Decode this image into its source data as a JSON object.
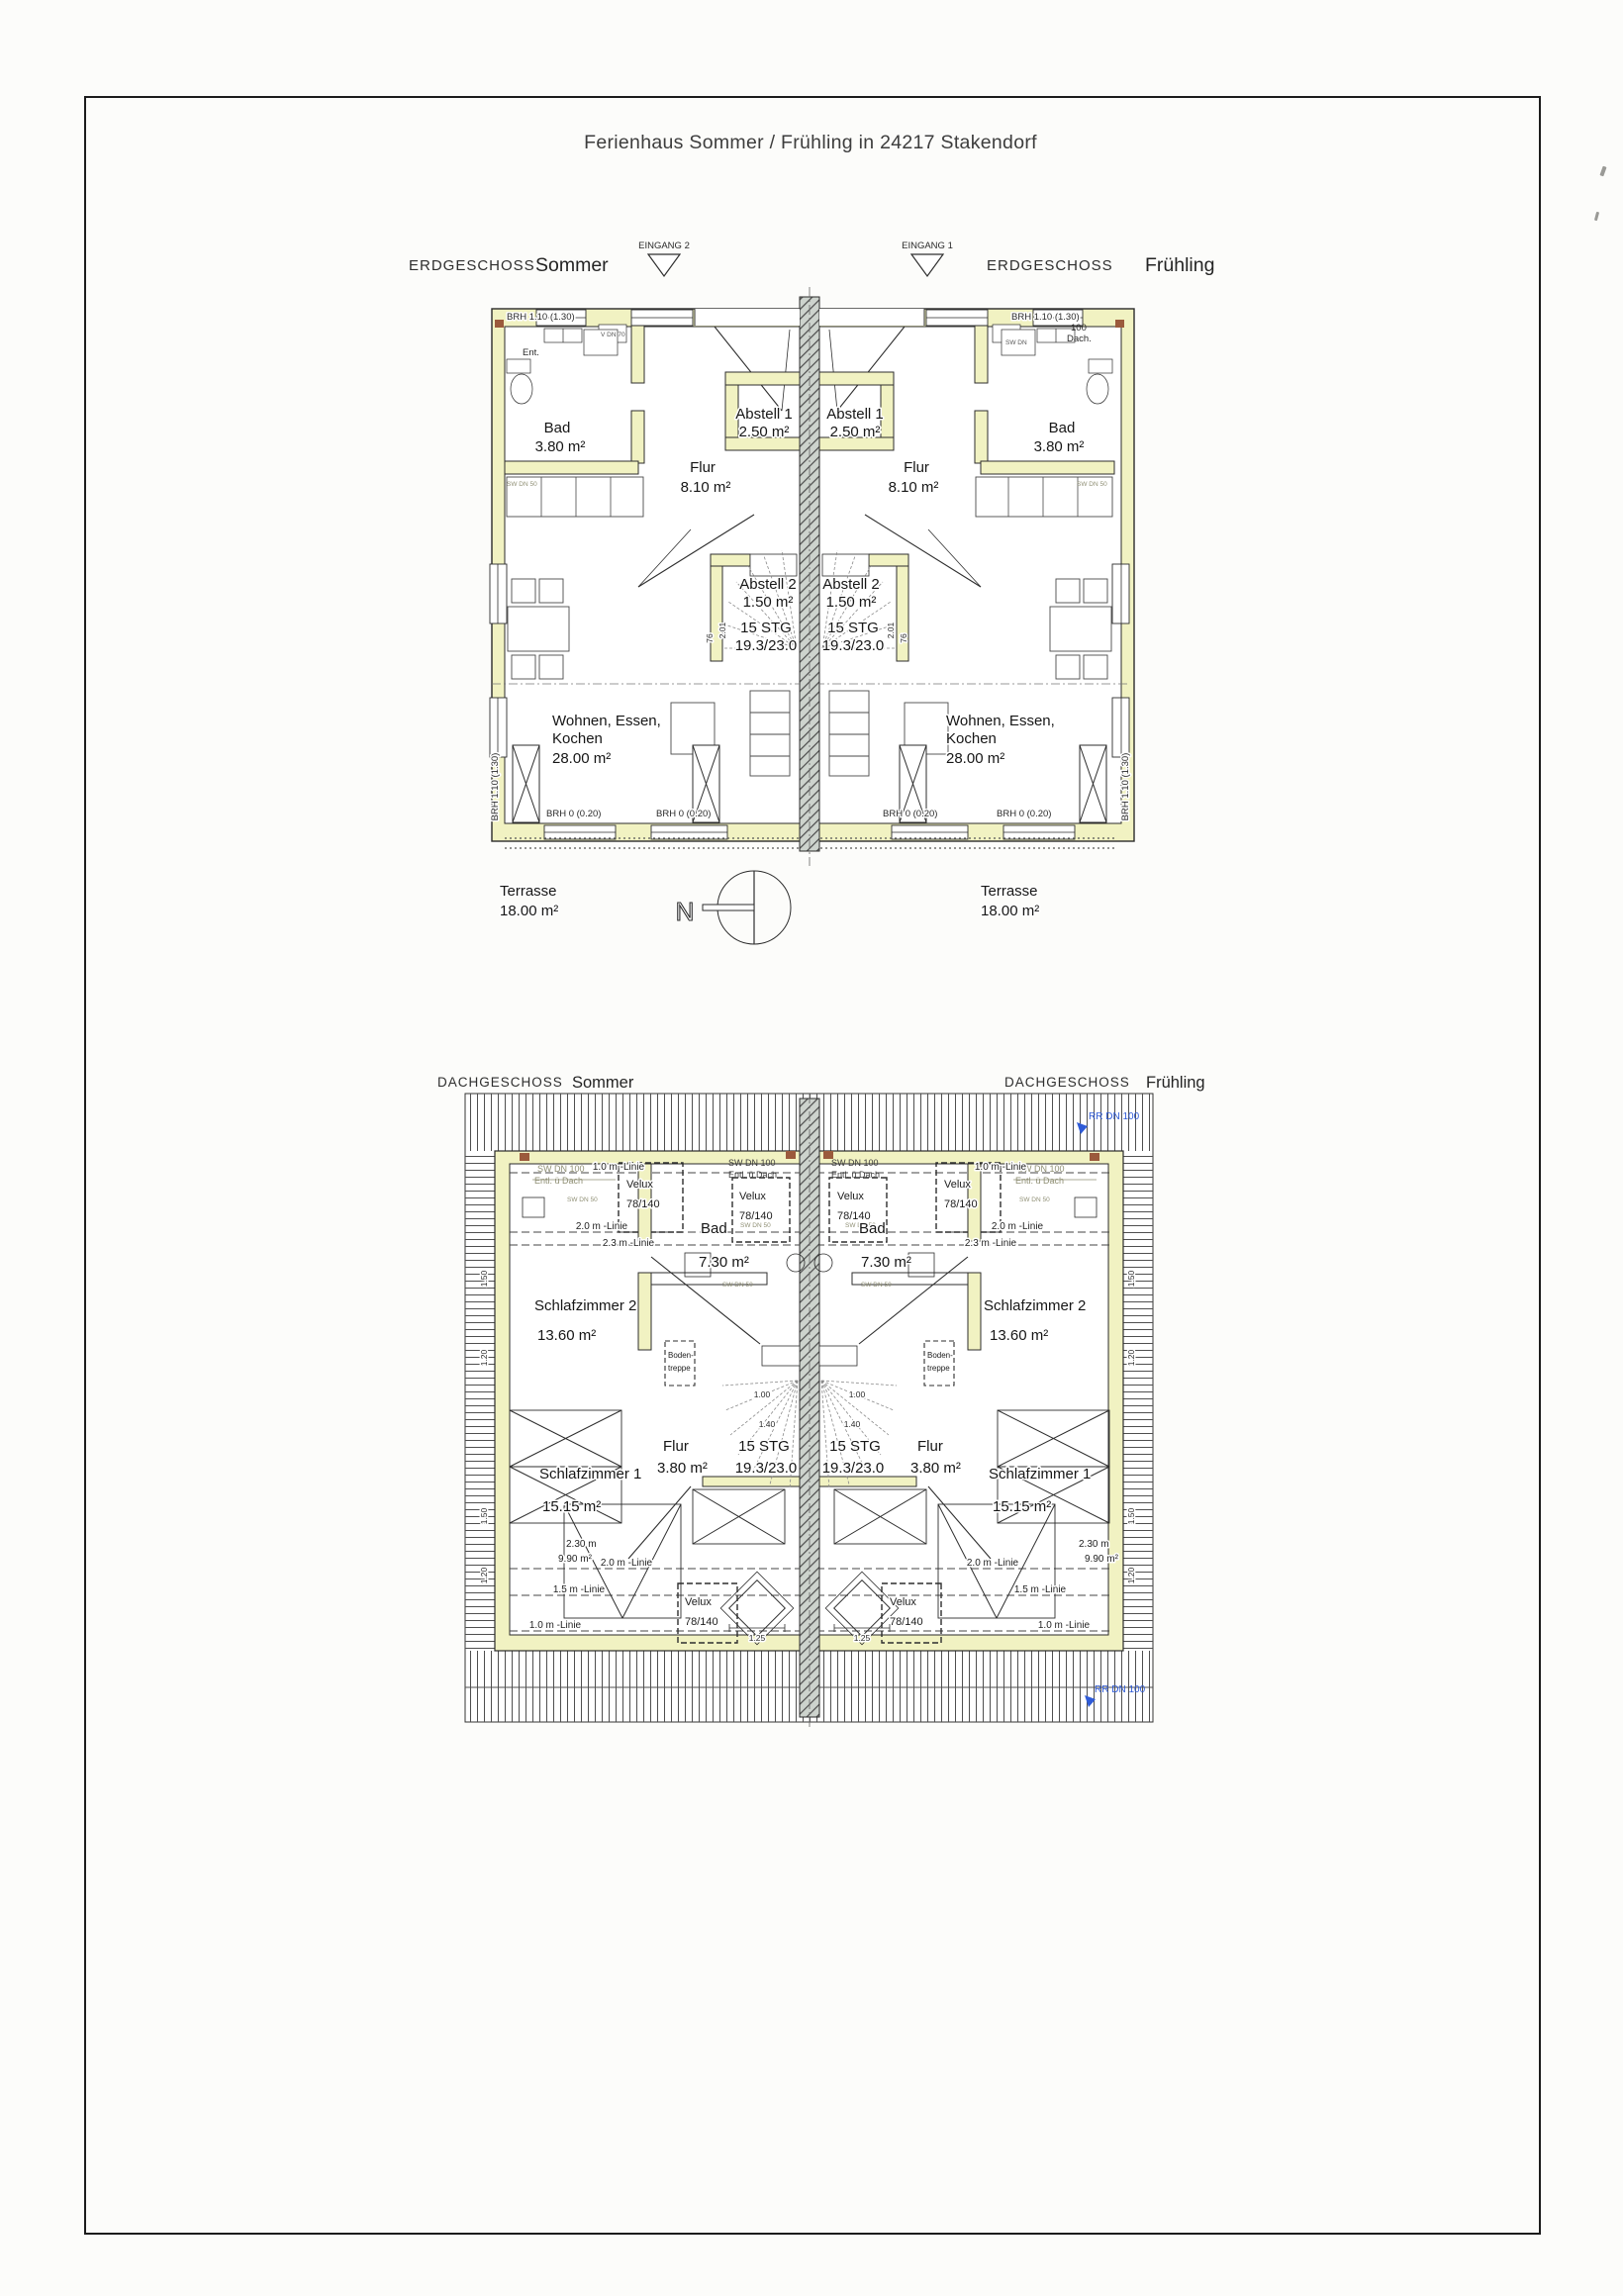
{
  "document": {
    "title": "Ferienhaus Sommer / Frühling in 24217 Stakendorf"
  },
  "colors": {
    "wall_yellow": "#f1f2c2",
    "party_wall_gray": "#cdd3cd",
    "note_blue": "#2f5bd7",
    "note_olive": "#8f8f74",
    "line_dark": "#2e2e2e"
  },
  "eg": {
    "heading_left_type": "ERDGESCHOSS",
    "heading_left_name": "Sommer",
    "heading_right_type": "ERDGESCHOSS",
    "heading_right_name": "Frühling",
    "eingang2": "EINGANG 2",
    "eingang1": "EINGANG 1",
    "bad_name": "Bad",
    "bad_area": "3.80 m²",
    "flur_name": "Flur",
    "flur_area": "8.10 m²",
    "abstell1_name": "Abstell 1",
    "abstell1_area": "2.50 m²",
    "abstell2_name": "Abstell 2",
    "abstell2_area": "1.50 m²",
    "stg_line1": "15 STG",
    "stg_line2": "19.3/23.0",
    "wohnen_line1": "Wohnen, Essen,",
    "wohnen_line2": "Kochen",
    "wohnen_area": "28.00 m²",
    "terrasse_name": "Terrasse",
    "terrasse_area": "18.00 m²",
    "brh_top": "BRH 1.10 (1.30)",
    "brh_side": "BRH 1.10 (1.30)",
    "brh_bottom": "BRH 0 (0.20)",
    "note_100": "100",
    "note_dach": "Dach.",
    "note_ent": "Ent.",
    "note_sw_dn": "SW DN",
    "note_v_dn": "V DN 70",
    "note_sw_dn_50": "SW DN 50",
    "dim_201": "2.01",
    "dim_76": "76",
    "compass_n": "N"
  },
  "dg": {
    "heading_left_type": "DACHGESCHOSS",
    "heading_left_name": "Sommer",
    "heading_right_type": "DACHGESCHOSS",
    "heading_right_name": "Frühling",
    "schlafzimmer2_name": "Schlafzimmer 2",
    "schlafzimmer2_area": "13.60 m²",
    "bad_name": "Bad",
    "bad_area": "7.30 m²",
    "flur_name": "Flur",
    "flur_area": "3.80 m²",
    "schlafzimmer1_name": "Schlafzimmer 1",
    "schlafzimmer1_area": "15.15 m²",
    "stg_line1": "15 STG",
    "stg_line2": "19.3/23.0",
    "bodentreppe_line1": "Boden-",
    "bodentreppe_line2": "treppe",
    "velux_line1": "Velux",
    "velux_line2": "78/140",
    "linie_10": "1.0 m -Linie",
    "linie_20": "2.0 m -Linie",
    "linie_23": "2.3 m -Linie",
    "linie_15": "1.5 m -Linie",
    "rr_dn_100": "RR DN 100",
    "sw_dn_100": "SW DN 100",
    "entl_dach": "Entl. ü Dach",
    "sw_dn_50": "SW DN 50",
    "dim_230": "2.30 m",
    "dim_990": "9.90 m²",
    "dim_125": "1.25",
    "dim_140": "1.40",
    "dim_100": "1.00",
    "dim_150": "1.50",
    "dim_120": "1.20"
  }
}
